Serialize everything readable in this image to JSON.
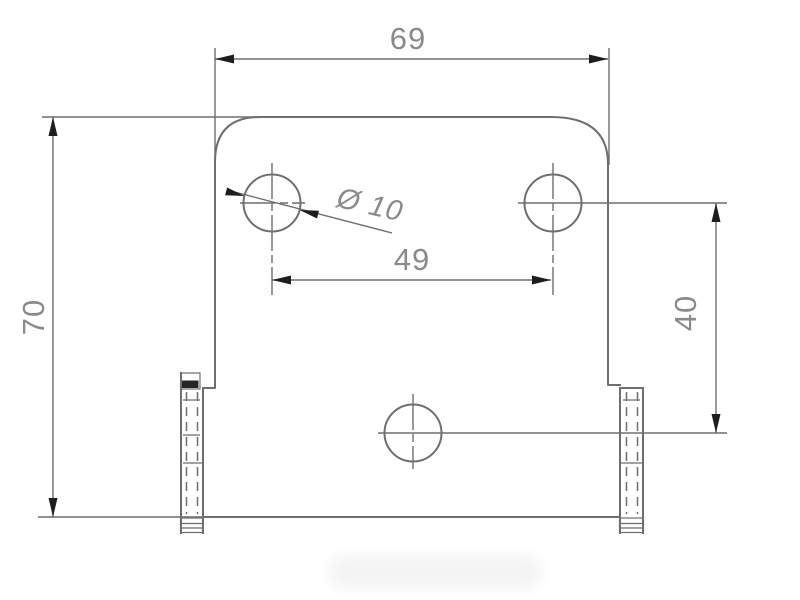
{
  "labels": {
    "overall_width": "69",
    "overall_height": "70",
    "hole_spacing": "49",
    "hole_row_offset": "40",
    "hole_diameter": "Ø 10"
  },
  "colors": {
    "background": "#ffffff",
    "line": "#6e6e6e",
    "arrow": "#1e1e1e",
    "text": "#8a8a8a",
    "hatch": "#262626",
    "smudge": "#f5f4f4"
  }
}
